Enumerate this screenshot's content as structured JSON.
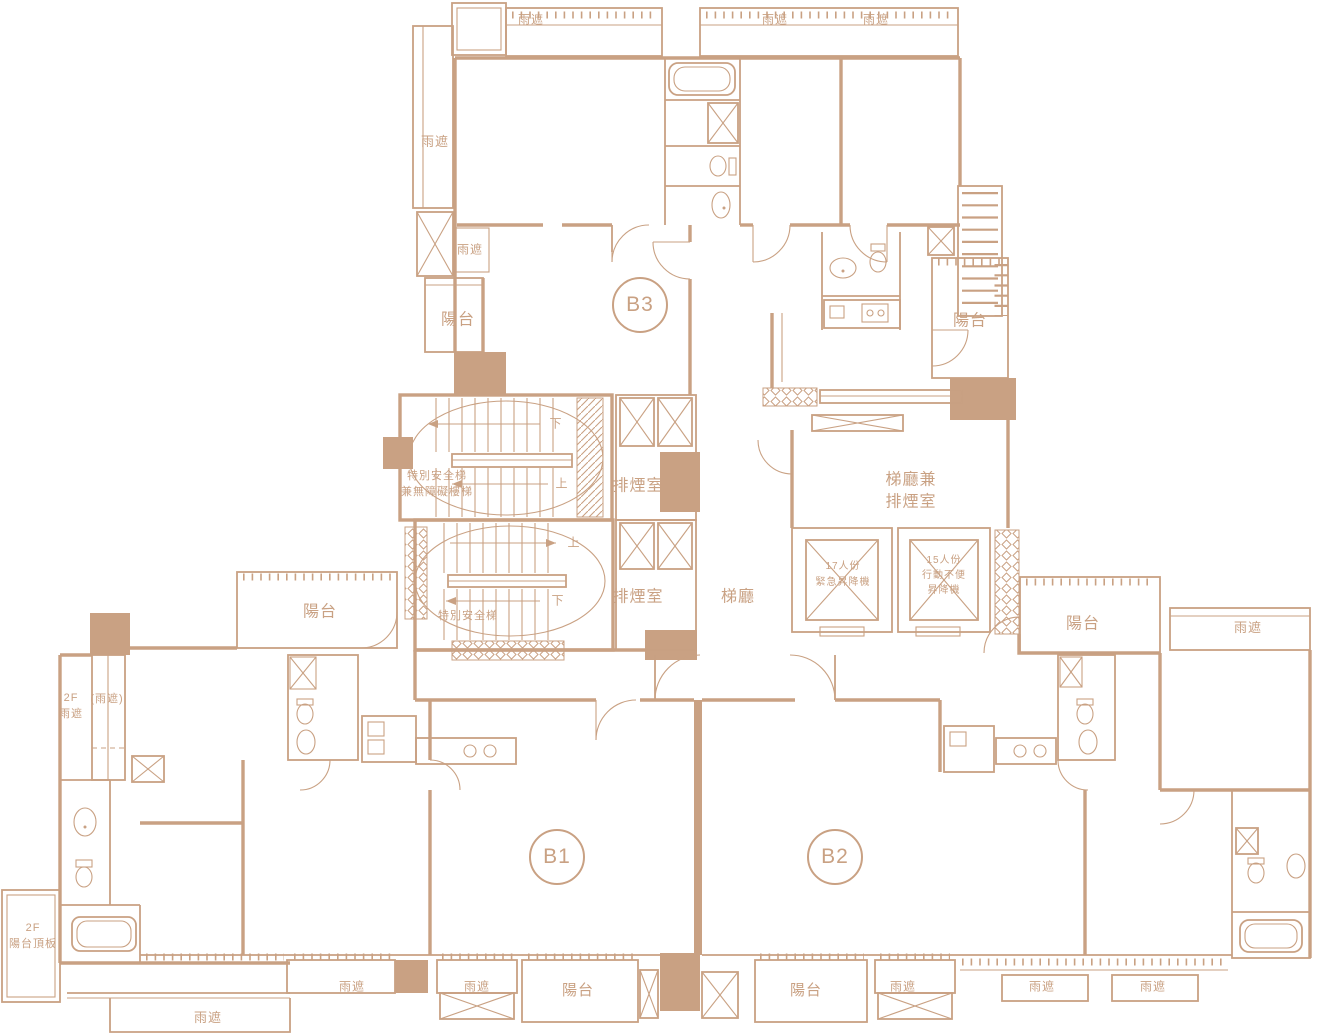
{
  "plan": {
    "colors": {
      "line": "#C9A183",
      "background": "#FFFFFF"
    },
    "units": [
      {
        "id": "B3",
        "x": 640,
        "y": 305
      },
      {
        "id": "B1",
        "x": 557,
        "y": 857
      },
      {
        "id": "B2",
        "x": 835,
        "y": 857
      }
    ],
    "labels": [
      {
        "text": "雨遮",
        "x": 531,
        "y": 20,
        "fs": 12
      },
      {
        "text": "雨遮",
        "x": 775,
        "y": 20,
        "fs": 12
      },
      {
        "text": "雨遮",
        "x": 876,
        "y": 20,
        "fs": 12
      },
      {
        "text": "雨遮",
        "x": 435,
        "y": 142,
        "fs": 13
      },
      {
        "text": "雨遮",
        "x": 470,
        "y": 250,
        "fs": 12
      },
      {
        "text": "陽台",
        "x": 458,
        "y": 321,
        "fs": 16
      },
      {
        "text": "陽台",
        "x": 970,
        "y": 322,
        "fs": 16
      },
      {
        "text": "特別安全梯",
        "x": 437,
        "y": 477,
        "fs": 11
      },
      {
        "text": "兼無障礙樓梯",
        "x": 437,
        "y": 493,
        "fs": 11
      },
      {
        "text": "排煙室",
        "x": 638,
        "y": 487,
        "fs": 16
      },
      {
        "text": "下",
        "x": 556,
        "y": 424,
        "fs": 12
      },
      {
        "text": "上",
        "x": 562,
        "y": 484,
        "fs": 12
      },
      {
        "text": "梯廳兼",
        "x": 911,
        "y": 481,
        "fs": 16
      },
      {
        "text": "排煙室",
        "x": 911,
        "y": 503,
        "fs": 16
      },
      {
        "text": "上",
        "x": 574,
        "y": 543,
        "fs": 12
      },
      {
        "text": "下",
        "x": 558,
        "y": 601,
        "fs": 12
      },
      {
        "text": "特別安全梯",
        "x": 468,
        "y": 617,
        "fs": 11
      },
      {
        "text": "排煙室",
        "x": 638,
        "y": 598,
        "fs": 16
      },
      {
        "text": "梯廳",
        "x": 738,
        "y": 598,
        "fs": 16
      },
      {
        "text": "17人份",
        "x": 843,
        "y": 567,
        "fs": 10
      },
      {
        "text": "緊急昇降機",
        "x": 843,
        "y": 583,
        "fs": 10
      },
      {
        "text": "15人份",
        "x": 944,
        "y": 561,
        "fs": 10
      },
      {
        "text": "行動不便",
        "x": 944,
        "y": 576,
        "fs": 10
      },
      {
        "text": "昇降機",
        "x": 944,
        "y": 591,
        "fs": 10
      },
      {
        "text": "陽台",
        "x": 320,
        "y": 613,
        "fs": 16
      },
      {
        "text": "陽台",
        "x": 1083,
        "y": 625,
        "fs": 16
      },
      {
        "text": "雨遮",
        "x": 1248,
        "y": 628,
        "fs": 13
      },
      {
        "text": "(雨遮)",
        "x": 107,
        "y": 700,
        "fs": 11
      },
      {
        "text": "2F",
        "x": 71,
        "y": 699,
        "fs": 11
      },
      {
        "text": "雨遮",
        "x": 71,
        "y": 715,
        "fs": 11
      },
      {
        "text": "2F",
        "x": 33,
        "y": 929,
        "fs": 11
      },
      {
        "text": "陽台頂板",
        "x": 33,
        "y": 945,
        "fs": 11
      },
      {
        "text": "雨遮",
        "x": 208,
        "y": 1018,
        "fs": 13
      },
      {
        "text": "雨遮",
        "x": 352,
        "y": 987,
        "fs": 12
      },
      {
        "text": "雨遮",
        "x": 477,
        "y": 987,
        "fs": 12
      },
      {
        "text": "陽台",
        "x": 578,
        "y": 991,
        "fs": 15
      },
      {
        "text": "陽台",
        "x": 806,
        "y": 991,
        "fs": 15
      },
      {
        "text": "雨遮",
        "x": 903,
        "y": 987,
        "fs": 12
      },
      {
        "text": "雨遮",
        "x": 1042,
        "y": 987,
        "fs": 12
      },
      {
        "text": "雨遮",
        "x": 1153,
        "y": 987,
        "fs": 12
      }
    ]
  }
}
